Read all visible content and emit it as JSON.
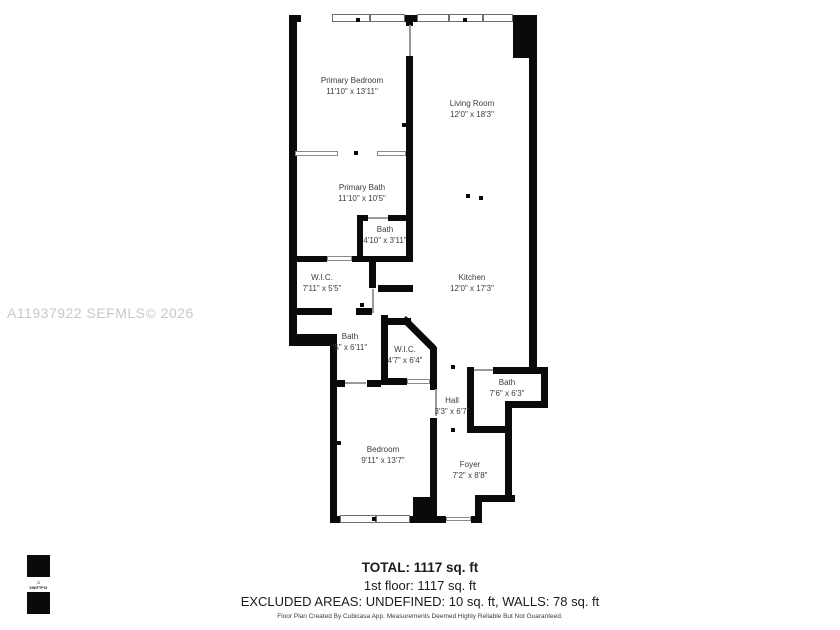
{
  "watermark": "A11937922  SEFMLS© 2026",
  "logo": {
    "brand": "SWIFTPIX",
    "house_icon": "⌂"
  },
  "rooms": {
    "primary_bedroom": {
      "name": "Primary Bedroom",
      "dims": "11'10\" x 13'11\""
    },
    "living_room": {
      "name": "Living Room",
      "dims": "12'0\" x 18'3\""
    },
    "primary_bath": {
      "name": "Primary Bath",
      "dims": "11'10\" x 10'5\""
    },
    "bath_small": {
      "name": "Bath",
      "dims": "4'10\" x 3'11\""
    },
    "wic_large": {
      "name": "W.I.C.",
      "dims": "7'11\" x 5'5\""
    },
    "kitchen": {
      "name": "Kitchen",
      "dims": "12'0\" x 17'3\""
    },
    "bath_mid": {
      "name": "Bath",
      "dims": "'5\" x 6'11\""
    },
    "wic_small": {
      "name": "W.I.C.",
      "dims": "4'7\" x 6'4\""
    },
    "bath_lower": {
      "name": "Bath",
      "dims": "7'6\" x 6'3\""
    },
    "hall": {
      "name": "Hall",
      "dims": "3'3\" x 6'7\""
    },
    "bedroom": {
      "name": "Bedroom",
      "dims": "9'11\" x 13'7\""
    },
    "foyer": {
      "name": "Foyer",
      "dims": "7'2\" x 8'8\""
    }
  },
  "summary": {
    "total": "TOTAL: 1117 sq. ft",
    "floor1": "1st floor: 1117 sq. ft",
    "excluded": "EXCLUDED AREAS: UNDEFINED: 10 sq. ft, WALLS: 78 sq. ft",
    "disclaimer": "Floor Plan Created By Cubicasa App. Measurements Deemed Highly Reliable But Not Guaranteed."
  },
  "colors": {
    "wall": "#0a0a0a",
    "label_text": "#3c3c3c",
    "watermark": "#c8c8c8",
    "window_border": "#6e6e6e",
    "door": "#9a9a9a"
  }
}
